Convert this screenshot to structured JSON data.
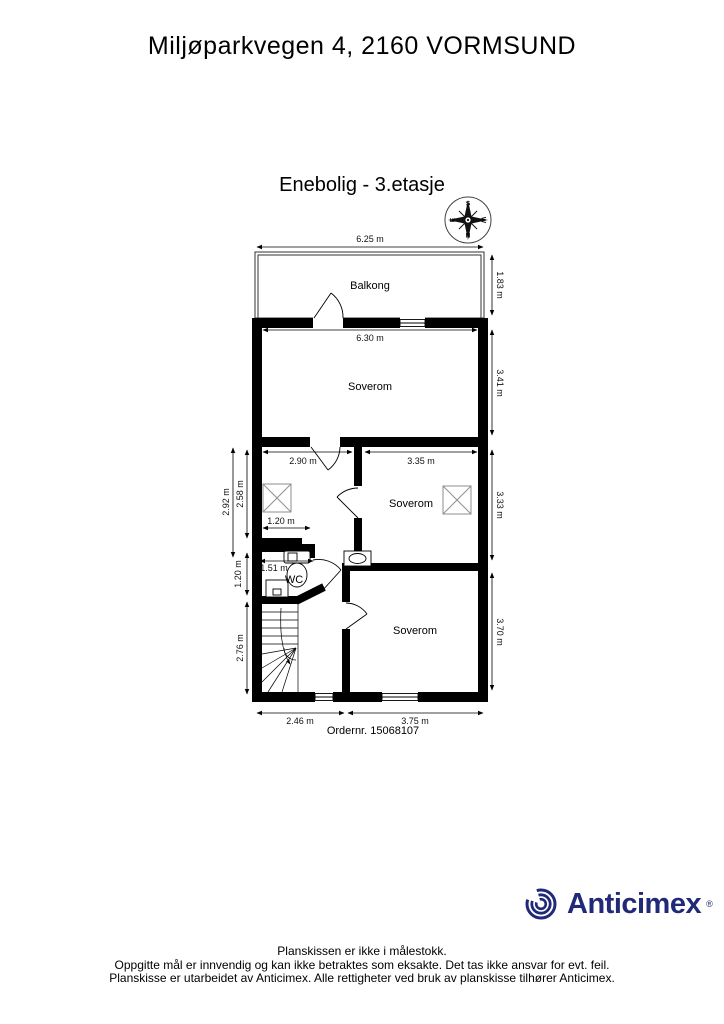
{
  "title": "Miljøparkvegen 4, 2160 VORMSUND",
  "subtitle": "Enebolig  - 3.etasje",
  "compass": {
    "n": "N",
    "s": "S",
    "e": "E",
    "w": "W"
  },
  "rooms": {
    "balcony": "Balkong",
    "bedroom_top": "Soverom",
    "bedroom_mid": "Soverom",
    "bedroom_bottom": "Soverom",
    "wc": "WC"
  },
  "dims": {
    "balcony_width": "6.25 m",
    "balcony_depth": "1.83 m",
    "bedroom_top_width": "6.30 m",
    "bedroom_top_depth": "3.41 m",
    "hall_width": "2.90 m",
    "bedroom_mid_width": "3.35 m",
    "bedroom_mid_depth": "3.33 m",
    "hall_depth_outer": "2.92 m",
    "hall_depth_inner": "2.58 m",
    "closet_width": "1.20 m",
    "wc_width": "1.51 m",
    "wc_depth": "1.20 m",
    "stairs_depth": "2.76 m",
    "bedroom_bottom_depth": "3.70 m",
    "bottom_left_width": "2.46 m",
    "bottom_right_width": "3.75 m"
  },
  "order_number": "Ordernr. 15068107",
  "logo": {
    "text": "Anticimex",
    "registered": "®",
    "color": "#202a78"
  },
  "icons": {
    "compass": "compass-rose",
    "logo_mark": "anticimex-swirl",
    "stairs": "winder-staircase",
    "toilet": "toilet",
    "wc_sink": "sink",
    "bedroom_sink": "sink",
    "skylight": "roof-window-x",
    "doors": "door-swing-arc",
    "windows": "double-line-window"
  },
  "footer": {
    "line1": "Planskissen er ikke i målestokk.",
    "line2": "Oppgitte mål er innvendig og kan ikke betraktes som eksakte. Det tas ikke ansvar for evt. feil.",
    "line3": "Planskisse er utarbeidet av Anticimex. Alle rettigheter ved bruk av planskisse tilhører Anticimex."
  }
}
